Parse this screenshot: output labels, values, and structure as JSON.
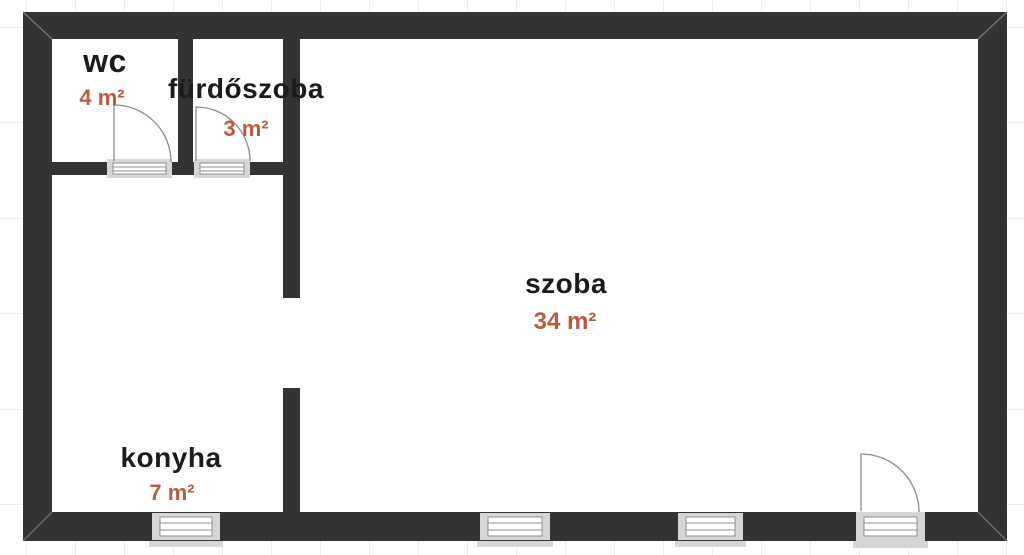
{
  "rooms": [
    {
      "id": "wc",
      "name": "wc",
      "area": "4 m²"
    },
    {
      "id": "furdoszoba",
      "name": "fürdőszoba",
      "area": "3 m²"
    },
    {
      "id": "szoba",
      "name": "szoba",
      "area": "34 m²"
    },
    {
      "id": "konyha",
      "name": "konyha",
      "area": "7 m²"
    }
  ],
  "symbols": {
    "doors": [
      "wc-door-swing",
      "bathroom-door-swing",
      "entrance-door-swing"
    ],
    "windows": [
      "kitchen-window",
      "room-window-left",
      "room-window-right"
    ],
    "openings": [
      "hall-to-room-passage"
    ]
  },
  "colors": {
    "background": "#ffffff",
    "wall": "#333333",
    "grid": "#ededed",
    "accent": "#bc5a40",
    "room_name": "#1c1c1c",
    "opening_frame": "#d6d6d6",
    "opening_detail": "#8f8f8f",
    "door_swing": "#8b8b8b",
    "miter": "#7a7a7a"
  }
}
